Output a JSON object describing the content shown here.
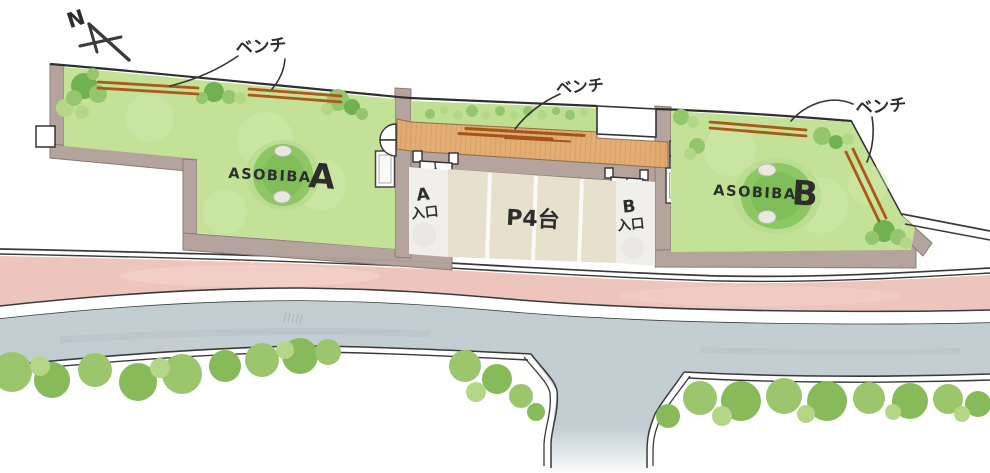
{
  "plan": {
    "north_label": "N",
    "bench_labels": {
      "left": "ベンチ",
      "center": "ベンチ",
      "right": "ベンチ"
    },
    "parcel_a": {
      "name": "ASOBIBA",
      "letter": "A"
    },
    "parcel_b": {
      "name": "ASOBIBA",
      "letter": "B"
    },
    "parking": {
      "label": "P4台"
    },
    "entrance_a": {
      "letter": "A",
      "word": "入口"
    },
    "entrance_b": {
      "letter": "B",
      "word": "入口"
    },
    "colors": {
      "lawn": "#c3e298",
      "lawn_wash": "#d2eaae",
      "green_strip": "#bfe093",
      "tree_dark": "#72b151",
      "tree_mid": "#94c66d",
      "tree_light": "#b3d787",
      "mound": "#8cc764",
      "mound_core": "#7cbb55",
      "mound_halo": "#b5da8d",
      "wall": "#b3a29a",
      "wall_edge": "#87786f",
      "deck": "#e3ac70",
      "deck_hatch": "#cd9351",
      "bench": "#ad5718",
      "path": "#f0efec",
      "parking_surface": "#e7e0cd",
      "stall_line": "#fbfaf6",
      "road_pink": "#eec5bc",
      "road_gray": "#c3ced3",
      "bush_mid": "#9bc66c",
      "bush_dark": "#87ba59",
      "line": "#3a3a3a",
      "ink": "#2d2d2d"
    }
  }
}
